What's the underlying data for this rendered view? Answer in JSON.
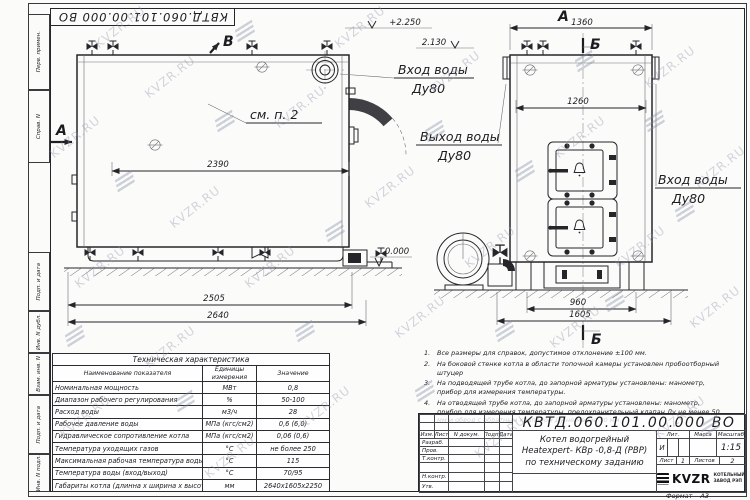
{
  "meta": {
    "doc_number": "КВТД.060.101.00.000 ВО",
    "format_label": "Формат",
    "format_value": "А3"
  },
  "watermark": {
    "text": "KVZR.RU"
  },
  "margin_labels": [
    "Перв. примен.",
    "Справ. N",
    "Подп. и дата",
    "Инв. N дубл.",
    "Взам. инв. N",
    "Подп. и дата",
    "Инв. N подл."
  ],
  "views": {
    "front": {
      "section_label_top": "В",
      "section_label_left": "А",
      "see_note": "см. п. 2",
      "elev_top": "+2.250",
      "elev_mid": "2.130",
      "elev_zero": "0.000",
      "dim_inner_width": "2390",
      "dim_width": "2505",
      "dim_overall_width": "2640",
      "inlet_label": "Вход воды",
      "inlet_dn": "Ду80",
      "outlet_label": "Выход воды",
      "outlet_dn": "Ду80"
    },
    "side": {
      "view_label": "А",
      "section_label": "Б",
      "dim_overall_width": "1360",
      "dim_inner_width": "1260",
      "dim_base": "960",
      "dim_overall_depth": "1605",
      "inlet_label": "Вход воды",
      "inlet_dn": "Ду80"
    }
  },
  "spec_table": {
    "title": "Техническая характеристика",
    "col_name": "Наименование показателя",
    "col_unit": "Единицы\nизмерения",
    "col_value": "Значение",
    "rows": [
      [
        "Номинальная мощность",
        "МВт",
        "0,8"
      ],
      [
        "Диапазон рабочего регулирования",
        "%",
        "50-100"
      ],
      [
        "Расход воды",
        "м3/ч",
        "28"
      ],
      [
        "Рабочее давление воды",
        "МПа (кгс/см2)",
        "0,6 (6,0)"
      ],
      [
        "Гидравлическое сопротивление котла",
        "МПа (кгс/см2)",
        "0,06 (0,6)"
      ],
      [
        "Температура уходящих газов",
        "°С",
        "не более 250"
      ],
      [
        "Максимальная рабочая температура воды",
        "°С",
        "115"
      ],
      [
        "Температура воды (вход/выход)",
        "°С",
        "70/95"
      ],
      [
        "Габариты котла (длинна х ширина х высота)",
        "мм",
        "2640х1605х2250"
      ]
    ]
  },
  "notes": [
    {
      "n": "1.",
      "text": "Все размеры для справок, допустимое отклонение ±100 мм."
    },
    {
      "n": "2.",
      "text": "На боковой стенке котла в области топочной камеры установлен пробоотборный штуцер"
    },
    {
      "n": "3.",
      "text": "На подводящей трубе котла, до запорной арматуры установлены: манометр, прибор для измерения температуры."
    },
    {
      "n": "4.",
      "text": "На отводящей трубе котла, до запорной арматуры установлены: манометр, прибор для измерения температуры, предохранительный клапан Ду не менее 50 мм и обвод с обратным клапаном Ду не менее 50 мм."
    }
  ],
  "title_block": {
    "header_cols": [
      "Изм.",
      "Лист",
      "N докум.",
      "Подп.",
      "Дата"
    ],
    "roles": [
      "Разраб.",
      "Пров.",
      "Т.контр.",
      "Н.контр.",
      "Утв."
    ],
    "name_line1": "Котел водогрейный",
    "name_line2": "Heatexpert- КВр -0,8-Д (РВР)",
    "name_line3": "по техническому заданию",
    "lit_label": "Лит.",
    "lit_value": "И",
    "mass_label": "Масса",
    "scale_label": "Масштаб",
    "scale_value": "1:15",
    "sheet_label": "Лист",
    "sheet_value": "1",
    "sheets_label": "Листов",
    "sheets_value": "2",
    "company": "KVZR",
    "company_line1": "КОТЕЛЬНЫЙ",
    "company_line2": "ЗАВОД РЭП"
  }
}
